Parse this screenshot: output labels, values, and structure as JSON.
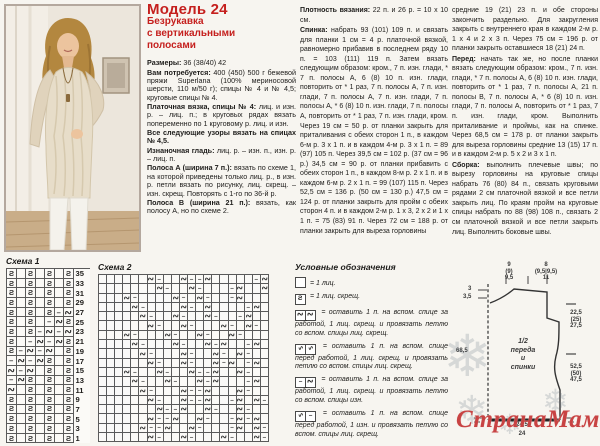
{
  "left_column": {
    "title": "Модель 24",
    "subtitle": "Безрукавка\nс вертикальными\nполосами",
    "paragraphs": [
      {
        "lead": "Размеры:",
        "text": " 36 (38/40) 42"
      },
      {
        "lead": "Вам потребуется:",
        "text": " 400 (450) 500 г бежевой пряжи Superlana (100% мериносовой шерсти, 110 м/50 г); спицы № 4 и № 4,5; круговые спицы № 4."
      },
      {
        "lead": "Платочная вязка, спицы № 4:",
        "text": " лиц. и изн. р. – лиц. п.; в круговых рядах вязать попеременно по 1 круговому р. лиц. и изн."
      },
      {
        "lead": "Все следующие узоры вязать на спицах № 4,5.",
        "text": ""
      },
      {
        "lead": "Изнаночная гладь:",
        "text": " лиц. р. – изн. п., изн. р. – лиц. п."
      },
      {
        "lead": "Полоса А (ширина 7 п.):",
        "text": " вязать по схеме 1, на которой приведены только лиц. р., в изн. р. петли вязать по рисунку, лиц. скрещ. – изн. скрещ. Повторять с 1-го по 36-й р."
      },
      {
        "lead": "Полоса В (ширина 21 п.):",
        "text": " вязать, как полосу А, но по схеме 2."
      }
    ]
  },
  "middle_column": {
    "paragraphs": [
      {
        "lead": "Плотность вязания:",
        "text": " 22 п. и 26 р. = 10 х 10 см."
      },
      {
        "lead": "Спинка:",
        "text": " набрать 93 (101) 109 п. и связать для планки 1 см = 4 р. платочной вязкой, равномерно прибавив в последнем ряду 10 п. = 103 (111) 119 п. Затем вязать следующим образом: кром., 7 п. изн. глади, * 7 п. полосы А, 6 (8) 10 п. изн. глади, повторить от * 1 раз, 7 п. полосы А, 7 п. изн. глади, 7 п. полосы А, 7 п. изн. глади, 7 п. полосы А, * 6 (8) 10 п. изн. глади, 7 п. полосы А, повторить от * 1 раз, 7 п. изн. глади, кром. Через 19 см = 50 р. от планки закрыть для приталивания с обеих сторон 1 п., в каждом 6-м р. 3 х 1 п. и в каждом 4-м р. 3 х 1 п. = 89 (97) 105 п. Через 39,5 см = 102 р. (37 см = 96 р.) 34,5 см = 90 р. от планки прибавить с обеих сторон 1 п., в каждом 8-м р. 2 х 1 п. и в каждом 6-м р. 2 х 1 п. = 99 (107) 115 п. Через 52,5 см = 136 р. (50 см = 130 р.) 47,5 см = 124 р. от планки закрыть для пройм с обеих сторон 4 п. и в каждом 2-м р. 1 х 3, 2 х 2 и 1 х 1 п. = 75 (83) 91 п. Через 72 см = 188 р. от планки закрыть для выреза горловины"
      }
    ]
  },
  "right_column": {
    "paragraphs": [
      {
        "lead": "",
        "text": "средние 19 (21) 23 п. и обе стороны закончить раздельно. Для закругления закрыть с внутреннего края в каждом 2-м р. 1 х 4 и 2 х 3 п. Через 75 см = 196 р. от планки закрыть оставшиеся 18 (21) 24 п."
      },
      {
        "lead": "Перед:",
        "text": " начать так же, но после планки вязать следующим образом: кром., 7 п. изн. глади, * 7 п. полосы А, 6 (8) 10 п. изн. глади, повторить от * 1 раз, 7 п. полосы А, 21 п. полосы В, 7 п. полосы А, * 6 (8) 10 п. изн. глади, 7 п. полосы А, повторить от * 1 раз, 7 п. изн. глади, кром. Выполнить приталивание и проймы, как на спинке. Через 68,5 см = 178 р. от планки закрыть для выреза горловины средние 13 (15) 17 п. и в каждом 2-м р. 5 х 2 и 3 х 1 п."
      },
      {
        "lead": "Сборка:",
        "text": " выполнить плечевые швы; по вырезу горловины на круговые спицы набрать 76 (80) 84 п., связать круговыми рядами 2 см платочной вязкой и все петли закрыть лиц. По краям пройм на круговые спицы набрать по 88 (98) 108 п., связать 2 см платочной вязкой и все петли закрыть лиц. Выполнить боковые швы."
      }
    ]
  },
  "chart1": {
    "label": "Схема 1",
    "row_numbers": [
      35,
      33,
      31,
      29,
      27,
      25,
      23,
      21,
      19,
      17,
      15,
      13,
      11,
      9,
      7,
      5,
      3,
      1
    ],
    "rows": [
      "s.s.s.s",
      "s.s.s.s",
      "s.s.s.s",
      "s.s.s.s",
      "s.s.s-z",
      "s.s.-zs",
      "s.s-z-z",
      "s.-z-zs",
      "s-z-z.s",
      "-z-zs.s",
      "z-z.s.s",
      "-zs.s.s",
      "z.s.s.s",
      "s.s.s.s",
      "s.s.s.s",
      "s.s.s.s",
      "s.s.s.s",
      "s.s.s.s"
    ]
  },
  "chart2": {
    "label": "Схема 2",
    "rows": [
      "......z-..z--z.....-z",
      ".......z-..z-...-z..z",
      "...z-....z-.z-..-z...",
      "....z-....z-.z....-z.",
      ".....z-..z-..z-..-z..",
      "......z-..z-...z-.z-.",
      "...z-...z-..z-..z-...",
      "....z-...z-..z-z..-z.",
      ".....z-...z-..z-.z-..",
      "......z-..z-..z-z.-z.",
      "...z-..z-..z--z..z-..",
      "....z-..z-..z-z...-z.",
      ".....z-...z--z...z-..",
      "......z-..z--z..-z.z-",
      ".......z--z..z-..z-..",
      "......z--z..z-..-z-z.",
      ".....z--z..z-...-z.z-",
      "......z-..z-...z-..z-"
    ]
  },
  "legend": {
    "title": "Условные обозначения",
    "items": [
      {
        "icon": "knit-empty",
        "text": "= 1 лиц."
      },
      {
        "icon": "knit-twist",
        "text": "= 1 лиц. скрещ."
      },
      {
        "icon": "cross-back",
        "text": "= оставить 1 п. на вспом. спице за работой, 1 лиц. скрещ. и провязать петлю со вспом. спицы лиц. скрещ."
      },
      {
        "icon": "cross-front",
        "text": "= оставить 1 п. на вспом. спице перед работой, 1 лиц. скрещ. и провязать петлю со вспом. спицы лиц. скрещ."
      },
      {
        "icon": "cross-back-purl",
        "text": "= оставить 1 п. на вспом. спице за работой, 1 лиц. скрещ. и провязать петлю со вспом. спицы изн."
      },
      {
        "icon": "cross-front-purl",
        "text": "= оставить 1 п. на вспом. спице перед работой, 1 изн. и провязать петлю со вспом. спицы лиц. скрещ."
      }
    ]
  },
  "schematic": {
    "center_label": "1/2\nпереда\nи\nспинки",
    "top_left_stack": "9\n(9)\n9,5",
    "top_right_stack": "8\n(9,5|9,5)\n11",
    "left_tick_1": "3",
    "left_tick_2": "3,5",
    "left_height": "68,5",
    "right_upper_stack": "22,5\n(25)\n27,5",
    "right_lower_stack": "52,5\n(50)\n47,5",
    "bottom_width_1": "24,5",
    "bottom_width_2": "24"
  },
  "watermark": {
    "text": "СтранаМам.ру",
    "color": "#c84343"
  },
  "accents": {
    "heading_red": "#c5201e",
    "page_bg": "#f7f5f0"
  }
}
